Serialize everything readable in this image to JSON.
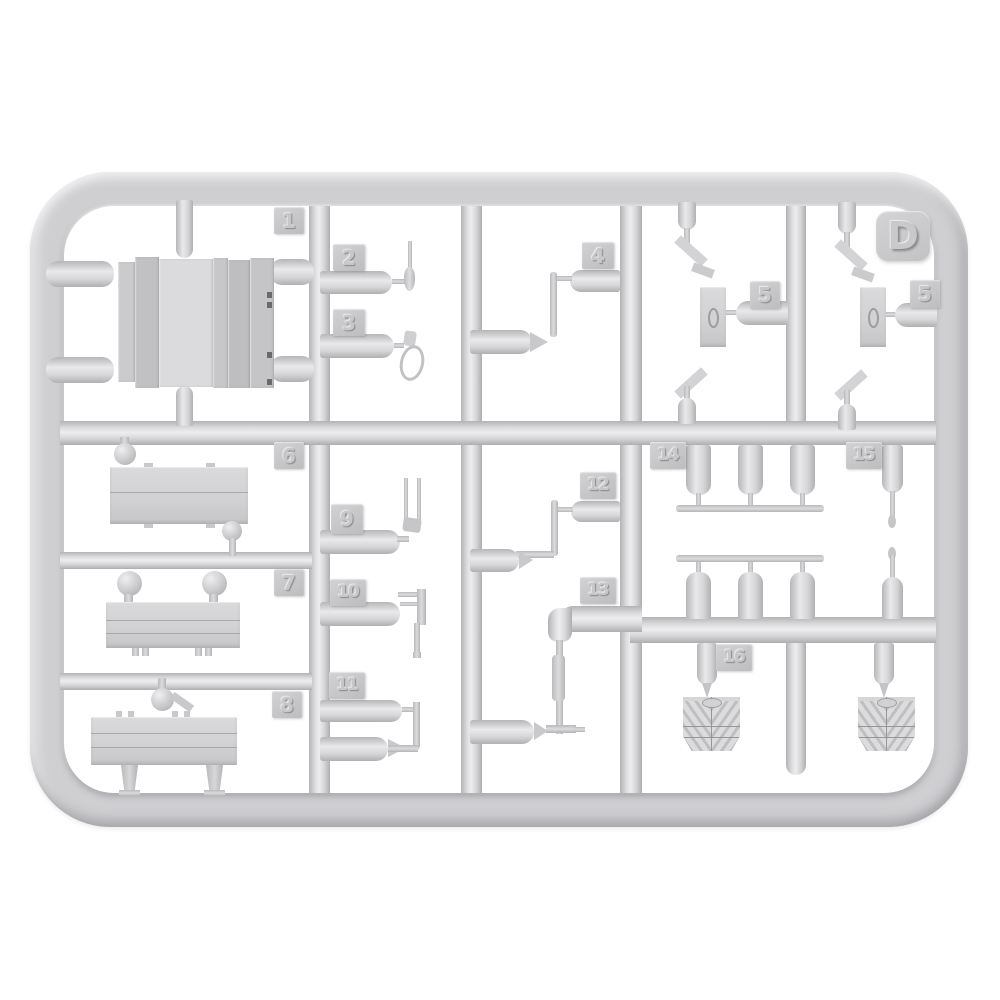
{
  "colors": {
    "background": "#ffffff",
    "plastic_base": "#d2d2d4",
    "plastic_highlight": "#ededef",
    "plastic_shadow": "#aeaeb2",
    "tag_face": "#c6c6c9"
  },
  "sprue": {
    "letter": "D",
    "tags": {
      "t1": "1",
      "t2": "2",
      "t3": "3",
      "t4": "4",
      "t5a": "5",
      "t5b": "5",
      "t6": "6",
      "t7": "7",
      "t8": "8",
      "t9": "9",
      "t10": "10",
      "t11": "11",
      "t12": "12",
      "t13": "13",
      "t14": "14",
      "t15": "15",
      "t16": "16"
    },
    "part_numbers": [
      "1",
      "2",
      "3",
      "4",
      "5",
      "6",
      "7",
      "8",
      "9",
      "10",
      "11",
      "12",
      "13",
      "14",
      "15",
      "16"
    ]
  }
}
